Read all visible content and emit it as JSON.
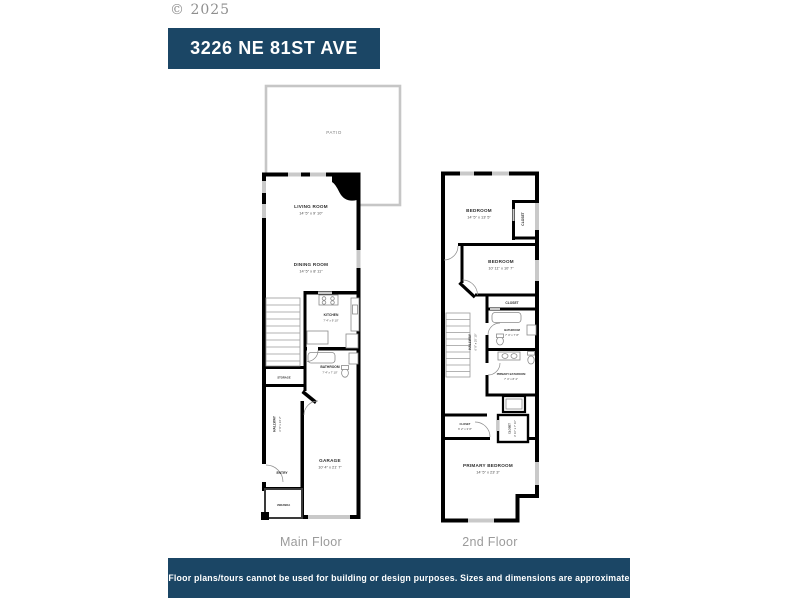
{
  "meta": {
    "copyright": "© 2025"
  },
  "header": {
    "address": "3226 NE 81ST AVE"
  },
  "footer": {
    "disclaimer": "Floor plans/tours cannot be used for building or design purposes. Sizes and dimensions are approximate"
  },
  "colors": {
    "navy": "#1b4665",
    "wall": "#000000",
    "window_gray": "#c9c9c9",
    "muted_text": "#9b9b9b"
  },
  "plans": {
    "main": {
      "label": "Main Floor",
      "rooms": {
        "patio": {
          "name": "PATIO"
        },
        "living": {
          "name": "LIVING ROOM",
          "dims": "14' 5\" x 9' 10\""
        },
        "dining": {
          "name": "DINING ROOM",
          "dims": "14' 5\" x 8' 11\""
        },
        "kitchen": {
          "name": "KITCHEN",
          "dims": "7' 4\" x 9' 10\""
        },
        "bathroom": {
          "name": "BATHROOM",
          "dims": "7' 4\" x 7' 10\""
        },
        "storage": {
          "name": "STORAGE"
        },
        "hallway": {
          "name": "HALLWAY",
          "dims": "6' 9\" x 34' 2\""
        },
        "entry": {
          "name": "ENTRY"
        },
        "garage": {
          "name": "GARAGE",
          "dims": "10' 4\" x 21' 7\""
        },
        "veranda": {
          "name": "VERANDA"
        }
      }
    },
    "second": {
      "label": "2nd Floor",
      "rooms": {
        "bedroom1": {
          "name": "BEDROOM",
          "dims": "14' 5\" x 13' 5\""
        },
        "closet1": {
          "name": "CLOSET"
        },
        "bedroom2": {
          "name": "BEDROOM",
          "dims": "10' 11\" x 10' 7\""
        },
        "closet2": {
          "name": "CLOSET"
        },
        "bathroom": {
          "name": "BATHROOM",
          "dims": "7' 4\" x 7' 8\""
        },
        "hallway": {
          "name": "HALLWAY",
          "dims": "6' 9\" x 25' 10\""
        },
        "primary_bathroom": {
          "name": "PRIMARY BATHROOM",
          "dims": "7' 4\" x 8' 4\""
        },
        "closet3": {
          "name": "CLOSET",
          "dims": "6' 2\" x 3' 8\""
        },
        "closet4": {
          "name": "CLOSET",
          "dims": "3' 10\" x 7' 10\""
        },
        "primary_bedroom": {
          "name": "PRIMARY BEDROOM",
          "dims": "14' 5\" x 23' 3\""
        }
      }
    }
  }
}
